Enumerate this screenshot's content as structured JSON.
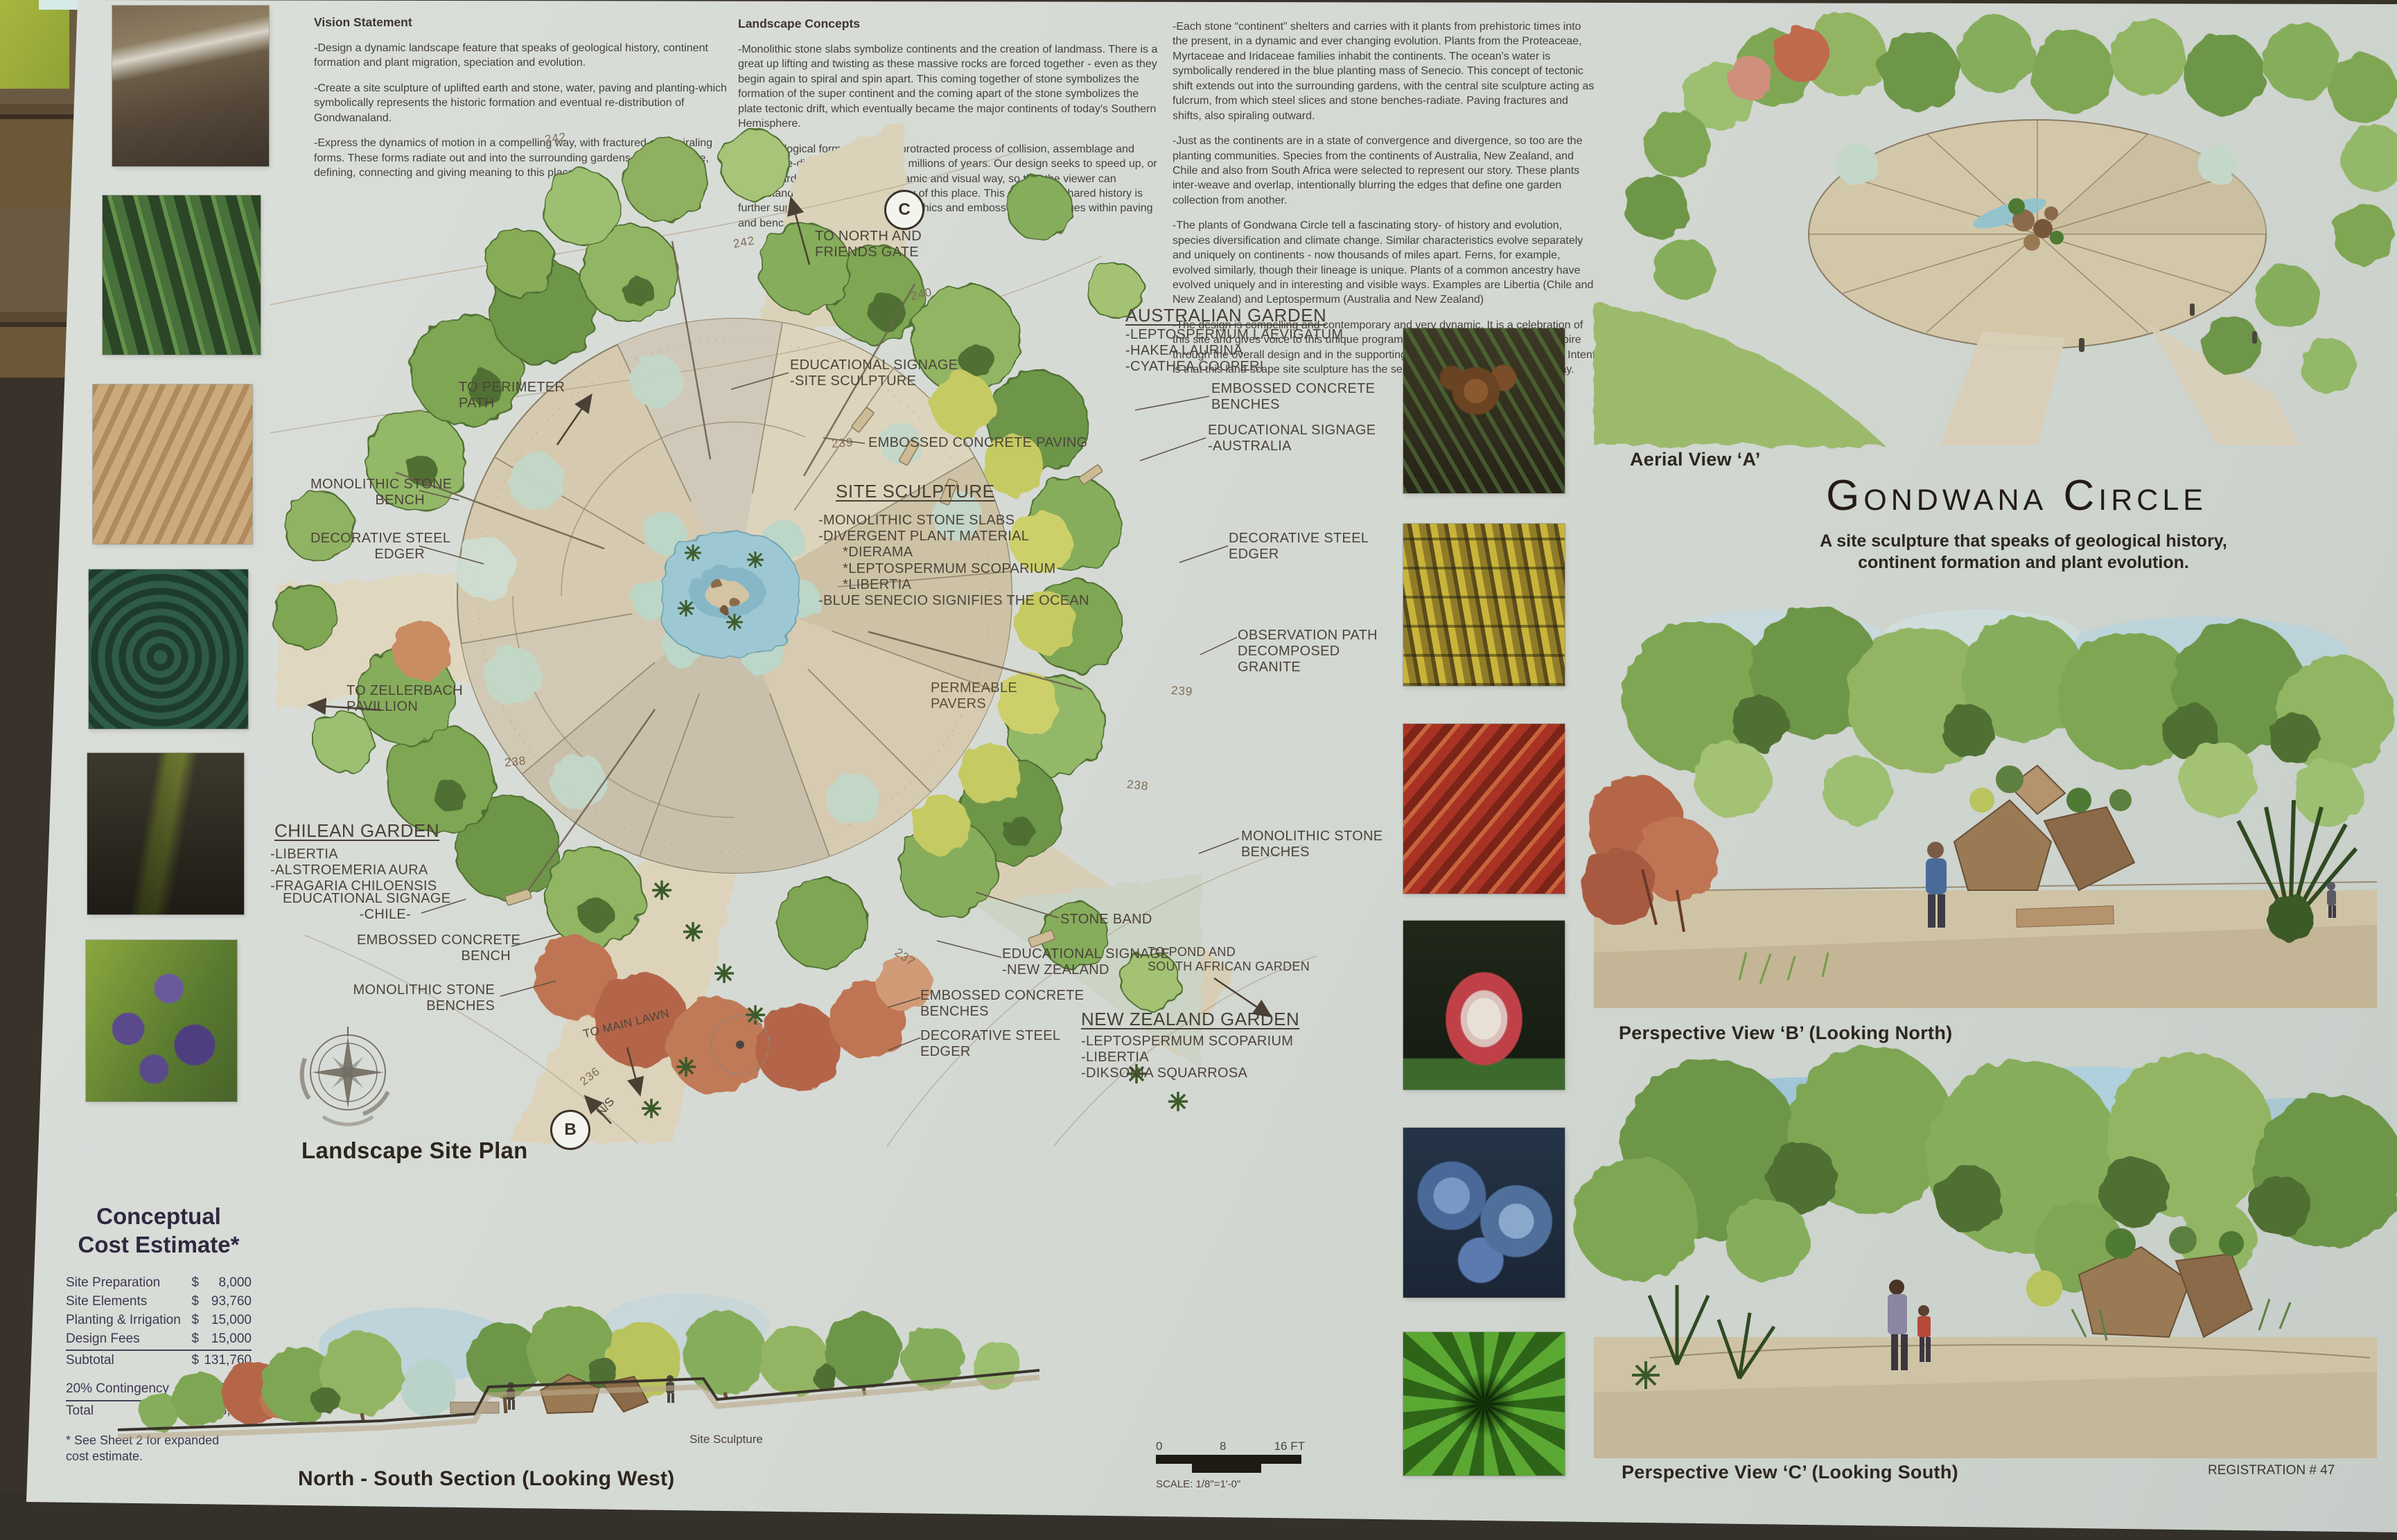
{
  "vision": {
    "title": "Vision Statement",
    "p1": "-Design a dynamic landscape feature that speaks of geological history, continent formation and plant migration, speciation and evolution.",
    "p2": "-Create a site sculpture of uplifted earth and stone, water, paving and planting-which symbolically represents the historic formation and eventual re-distribution of Gondwanaland.",
    "p3": "-Express the dynamics of motion in a compelling way, with fractured and spiraling forms. These forms radiate out and into the surrounding gardens and landscape, defining, connecting and giving meaning to this place."
  },
  "concepts": {
    "title": "Landscape Concepts",
    "p1": "-Monolithic stone slabs symbolize continents and the creation of landmass. There is a great up lifting and twisting as these massive rocks are forced together - even as they begin again to spiral and spin apart.  This coming together of stone symbolizes the formation of the super continent and the coming apart of the stone symbolizes the plate tectonic drift, which eventually became the major continents of today's Southern Hemisphere.",
    "p2": "-This geological formation was a protracted process of collision, assemblage and eventual re-distribution over many millions of years. Our design seeks to speed up, or fast-forward, this process in a dynamic and visual way, so that the viewer can understand and appreciate the story of this place.  This concept of shared history is further supported with signage & graphics and embossed fossil images within paving and benches."
  },
  "narrative": {
    "p1": "-Each stone “continent” shelters and carries with it plants from prehistoric times into the present, in a dynamic and ever changing evolution. Plants from the Proteaceae, Myrtaceae and Iridaceae families inhabit the continents. The ocean's water is symbolically rendered in the blue planting mass of Senecio.  This concept of tectonic shift extends out into the surrounding gardens, with the central site sculpture acting as fulcrum, from which steel slices and stone benches-radiate. Paving fractures and shifts, also spiraling outward.",
    "p2": "-Just as the continents are in a state of convergence and divergence, so too are the planting communities. Species from the continents of Australia, New Zealand, and Chile and also from South Africa were selected to represent our story.  These plants inter-weave and overlap, intentionally blurring the edges that define one garden collection from another.",
    "p3": "-The plants of Gondwana Circle tell a fascinating story- of history and evolution, species diversification and climate change.  Similar characteristics evolve separately and uniquely on continents - now thousands of miles apart.  Ferns, for example, evolved similarly, though their lineage is unique. Plants of a common ancestry have evolved uniquely and in interesting and visible ways. Examples are Libertia (Chile and New Zealand) and Leptospermum (Australia and New Zealand)",
    "p4": "-The design is compelling and contemporary and very dynamic. It is a celebration of this site and gives voice to this unique program.  Our intent is to educate and inspire through the overall design and in the supporting signage & graphics. Our design Intent is that this land-scape site sculpture has the sense of being In Motion, even today."
  },
  "plan": {
    "title": "Landscape Site Plan",
    "labels": [
      "TO NORTH AND\nFRIENDS GATE",
      "EDUCATIONAL SIGNAGE\n-SITE SCULPTURE",
      "EMBOSSED CONCRETE PAVING",
      "SITE SCULPTURE",
      "-MONOLITHIC STONE SLABS\n-DIVERGENT PLANT MATERIAL\n      *DIERAMA\n      *LEPTOSPERMUM SCOPARIUM\n      *LIBERTIA\n-BLUE SENECIO SIGNIFIES THE OCEAN",
      "TO PERIMETER\nPATH",
      "MONOLITHIC STONE\nBENCH",
      "DECORATIVE STEEL\nEDGER",
      "TO ZELLERBACH\nPAVILLION",
      "CHILEAN GARDEN",
      "-LIBERTIA\n-ALSTROEMERIA AURA\n-FRAGARIA CHILOENSIS",
      "EDUCATIONAL SIGNAGE\n-CHILE-",
      "EMBOSSED CONCRETE\nBENCH",
      "MONOLITHIC STONE\nBENCHES",
      "TO MAIN LAWN",
      "AUSTRALIAN GARDEN",
      "-LEPTOSPERMUM LAEVIGATUM\n-HAKEA LAURINA\n-CYATHEA COOPERI",
      "EMBOSSED CONCRETE\nBENCHES",
      "EDUCATIONAL SIGNAGE\n-AUSTRALIA",
      "DECORATIVE STEEL\nEDGER",
      "OBSERVATION PATH\nDECOMPOSED\nGRANITE",
      "MONOLITHIC STONE\nBENCHES",
      "STONE BAND",
      "EDUCATIONAL SIGNAGE\n-NEW ZEALAND",
      "TO POND AND\nSOUTH AFRICAN GARDEN",
      "EMBOSSED CONCRETE\nBENCHES",
      "DECORATIVE STEEL\nEDGER",
      "NEW ZEALAND GARDEN",
      "-LEPTOSPERMUM SCOPARIUM\n-LIBERTIA\n-DIKSONIA SQUARROSA",
      "PERMEABLE\nPAVERS"
    ],
    "contours": [
      "242",
      "242",
      "240",
      "239",
      "239",
      "238",
      "238",
      "237",
      "236"
    ],
    "markers": {
      "c": "C",
      "b": "B",
      "ns": "N/S"
    }
  },
  "section": {
    "caption": "North - South Section (Looking West)",
    "sculpture_label": "Site Sculpture",
    "scale_t0": "0",
    "scale_t1": "8",
    "scale_t2": "16 FT",
    "scale_caption": "SCALE: 1/8\"=1'-0\""
  },
  "cost": {
    "title": "Conceptual\nCost Estimate*",
    "rows": [
      {
        "label": "Site Preparation",
        "cur": "$",
        "amount": "8,000"
      },
      {
        "label": "Site Elements",
        "cur": "$",
        "amount": "93,760"
      },
      {
        "label": "Planting & Irrigation",
        "cur": "$",
        "amount": "15,000"
      },
      {
        "label": "Design Fees",
        "cur": "$",
        "amount": "15,000"
      },
      {
        "label": "Subtotal",
        "cur": "$",
        "amount": "131,760"
      },
      {
        "label": "20% Contingency",
        "cur": "$",
        "amount": "26,352"
      },
      {
        "label": "Total",
        "cur": "$",
        "amount": "158,112"
      }
    ],
    "footnote": "* See Sheet 2 for expanded\n  cost estimate."
  },
  "views": {
    "aerial_caption": "Aerial View ‘A’",
    "title": "Gondwana Circle",
    "subtitle": "A  site sculpture that speaks of geological history,\ncontinent formation and plant evolution.",
    "persp_b_caption": "Perspective View ‘B’ (Looking North)",
    "persp_c_caption": "Perspective View ‘C’ (Looking South)",
    "registration": "REGISTRATION # 47"
  }
}
